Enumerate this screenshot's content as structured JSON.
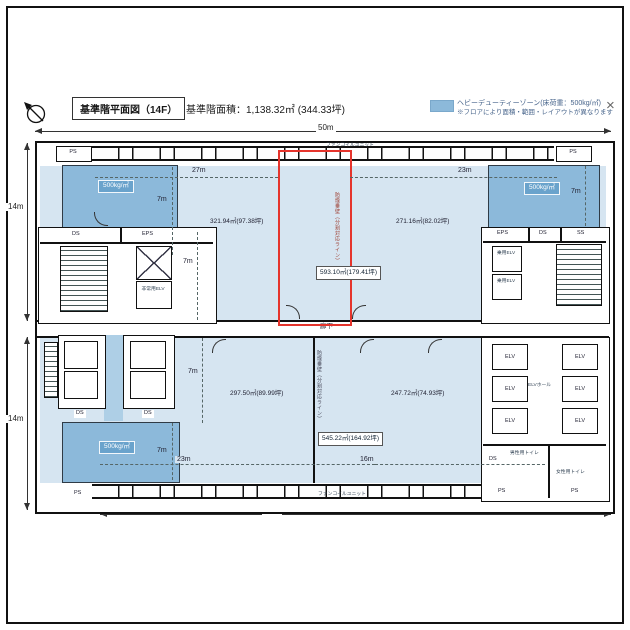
{
  "header": {
    "title": "基準階平面図（14F）",
    "area_total": "基準階面積：1,138.32㎡ (344.33坪)",
    "legend_line1": "ヘビーデューティーゾーン(床荷重：500kg/㎡)",
    "legend_line2": "※フロアにより面積・範囲・レイアウトが異なります",
    "close": "×",
    "accent_color": "#8cb9da"
  },
  "dims": {
    "top": "50m",
    "bottom": "39m",
    "left_upper": "14m",
    "left_lower": "14m",
    "span_upper_left": "27m",
    "span_upper_right": "23m",
    "span_lower_left": "23m",
    "span_lower_right": "16m",
    "depth": "7m"
  },
  "areas": {
    "upper_left": "321.94㎡(97.38坪)",
    "upper_right": "271.16㎡(82.02坪)",
    "upper_total": "593.10㎡(179.41坪)",
    "lower_left": "297.50㎡(89.99坪)",
    "lower_right": "247.72㎡(74.93坪)",
    "lower_total": "545.22㎡(164.92坪)"
  },
  "zone": {
    "load": "500kg/㎡",
    "color": "#8cb9da"
  },
  "labels": {
    "ps": "PS",
    "ds": "DS",
    "eps": "EPS",
    "ss": "SS",
    "elv": "ELV",
    "elv_hall": "ELVホール",
    "emergency_elv": "非常用ELV",
    "passenger_elv": "乗用ELV",
    "mens_toilet": "男性用トイレ",
    "womens_toilet": "女性用トイレ",
    "corridor": "廊下",
    "fan_coil": "ファンコイルユニット",
    "partition": "防煙垂壁（分割対応ライン）"
  }
}
